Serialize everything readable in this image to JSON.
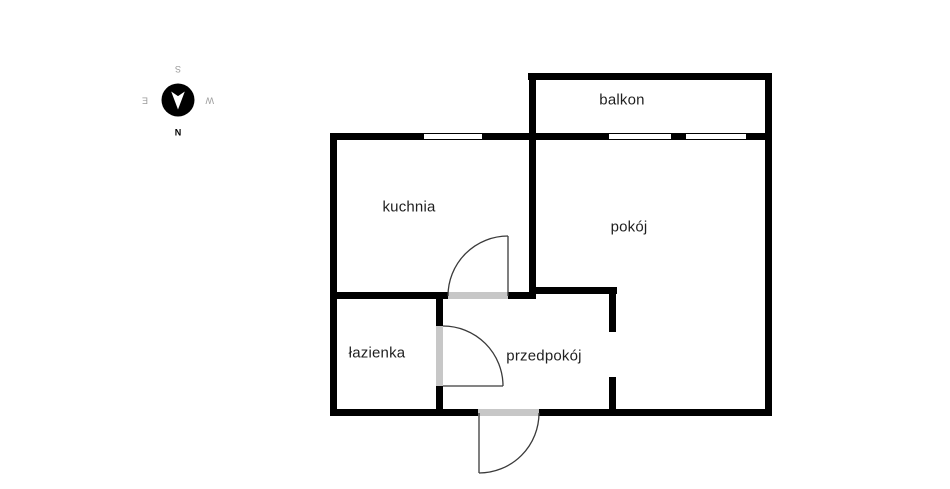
{
  "plan": {
    "rooms": [
      {
        "id": "balkon",
        "label": "balkon"
      },
      {
        "id": "kuchnia",
        "label": "kuchnia"
      },
      {
        "id": "pokoj",
        "label": "pokój"
      },
      {
        "id": "lazienka",
        "label": "łazienka"
      },
      {
        "id": "przedpokoj",
        "label": "przedpokój"
      }
    ]
  },
  "compass": {
    "north": "N",
    "east": "E",
    "south": "S",
    "west": "W"
  },
  "colors": {
    "wall": "#000000",
    "door_opening": "#c7c7c7",
    "door_line": "#3a3a3a",
    "label_text": "#1f1f1f",
    "compass_primary": "#000000",
    "compass_secondary": "#9b9b9b",
    "background": "#ffffff"
  }
}
